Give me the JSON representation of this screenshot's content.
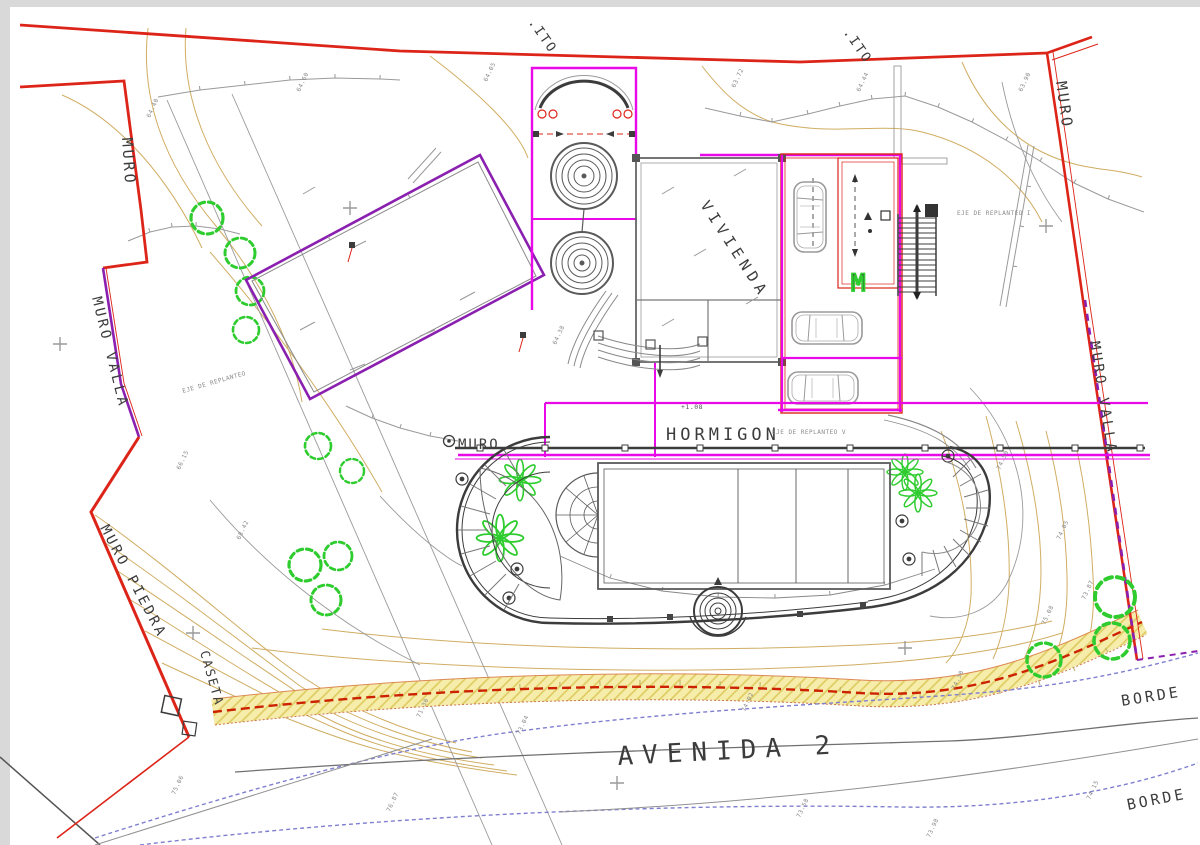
{
  "drawing": {
    "type": "site-plan",
    "labels": {
      "muro_top_left": "MURO",
      "muro_valla_left": "MURO VALLA",
      "muro_piedra": "MURO PIEDRA",
      "caseta": "CASETA",
      "ito_left": ".ITO",
      "ito_right": ".ITO",
      "muro_top_right": "MURO",
      "muro_valla_right": "MURO VALLA",
      "borde_upper": "BORDE",
      "borde_lower": "BORDE",
      "vivienda": "VIVIENDA",
      "hormigon": "HORMIGON",
      "muro_hormigon": "MURO",
      "eje_replanteo_i": "EJE DE REPLANTEO I",
      "eje_replanteo_v": "EJE DE REPLANTEO V",
      "eje_replanteo_left": "EJE DE REPLANTEO",
      "level_mark": "+1.08",
      "garage_m_mark": "M",
      "avenida": "AVENIDA 2"
    },
    "elevations": [
      "64.40",
      "64.60",
      "64.05",
      "63.72",
      "64.44",
      "63.90",
      "64.38",
      "74.50",
      "74.05",
      "73.87",
      "75.08",
      "74.30",
      "71.30",
      "73.04",
      "74.02",
      "75.06",
      "76.87",
      "73.58",
      "74.15",
      "73.98",
      "68.42",
      "66.15"
    ],
    "colors": {
      "boundary_red": "#dd2418",
      "outline_magenta": "#e808e8",
      "wall_purple": "#8a1fb0",
      "contour_tan": "#d0ad62",
      "contour_gray": "#9a9a9a",
      "wall_dark": "#3c3c3c",
      "tree_green": "#2fcc2f",
      "utility_blue": "#7f7fd0",
      "road_band_yellow": "#f6edab",
      "road_dash_red": "#cc2200"
    }
  }
}
